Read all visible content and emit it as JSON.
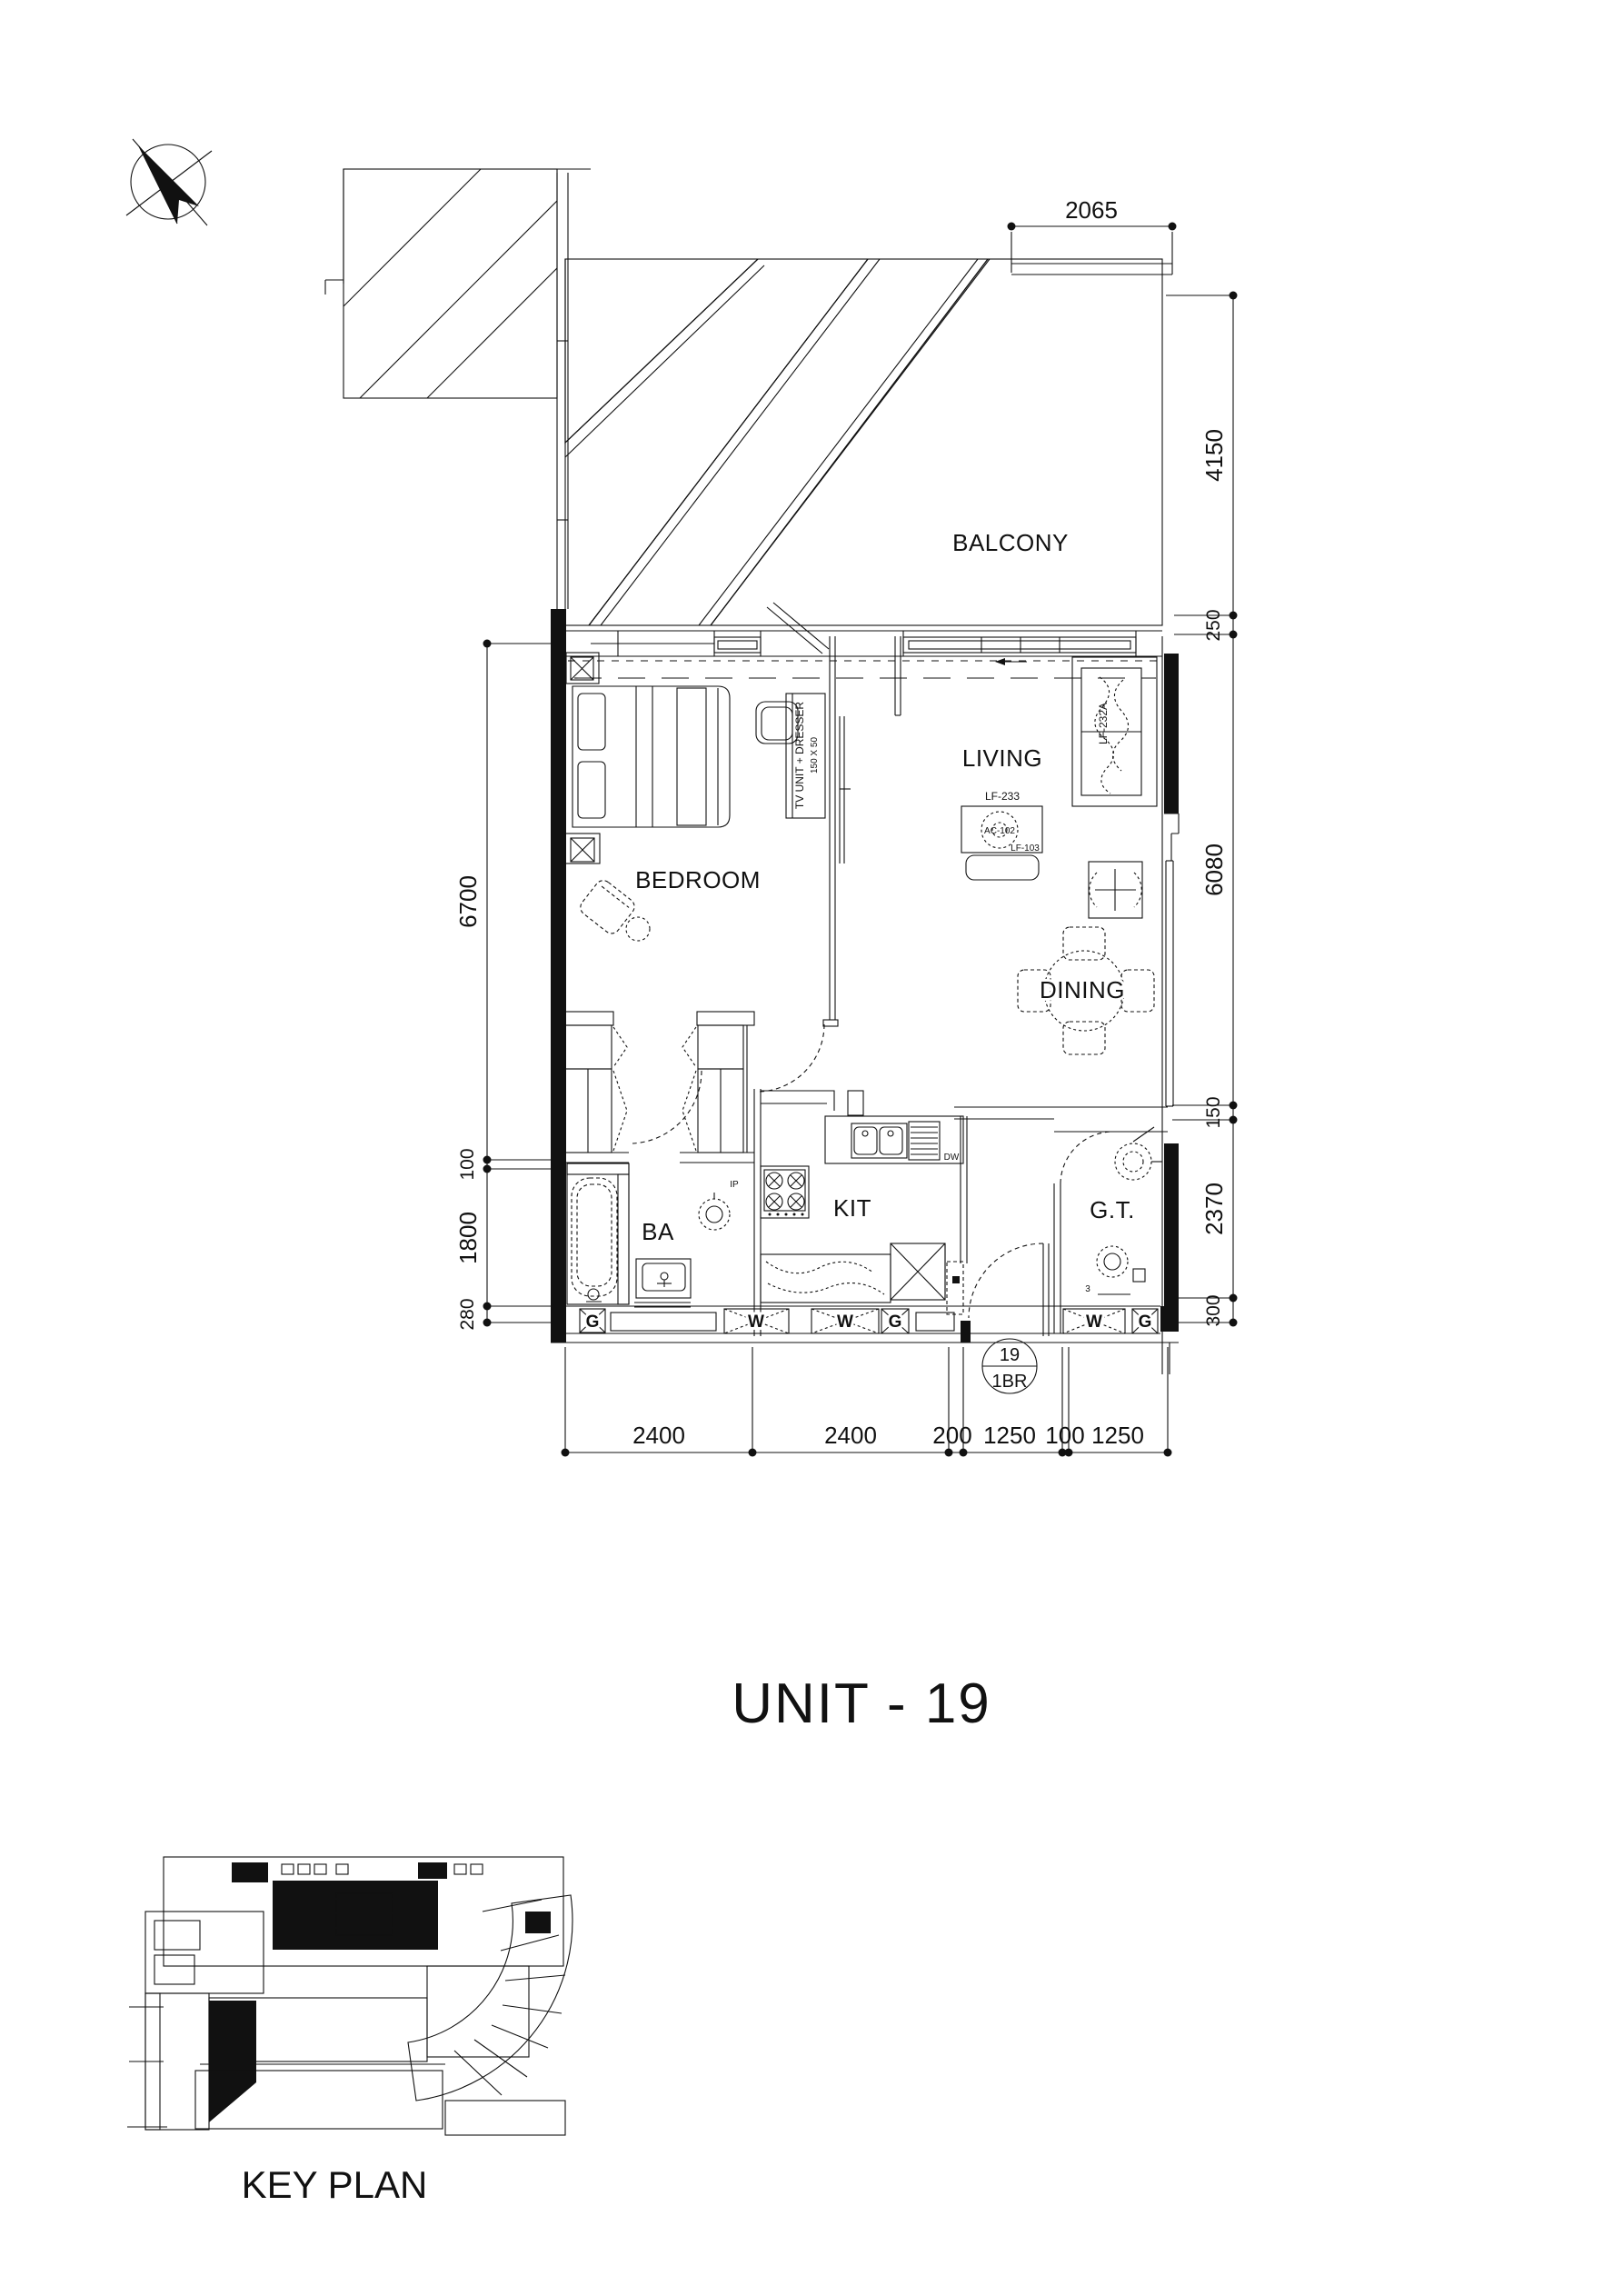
{
  "title": "UNIT - 19",
  "key_plan_label": "KEY PLAN",
  "badge": {
    "number": "19",
    "type": "1BR"
  },
  "rooms": {
    "balcony": "BALCONY",
    "bedroom": "BEDROOM",
    "living": "LIVING",
    "dining": "DINING",
    "bathroom": "BA",
    "kitchen": "KIT",
    "guest_toilet": "G.T."
  },
  "furniture": {
    "tv_unit": "TV UNIT + DRESSER",
    "tv_unit_size": "150 X 50",
    "sofa_tag": "LF-232A",
    "media_tag": "LF-233",
    "ac_tag": "AC-102",
    "table_tag": "LF-103",
    "dishwasher_tag": "DW",
    "bath_tag": "IP",
    "toilet_tag": "3"
  },
  "closets": {
    "w": "W",
    "g": "G"
  },
  "dimensions": {
    "top": [
      "2065"
    ],
    "right": [
      "4150",
      "250",
      "6080",
      "150",
      "2370",
      "300"
    ],
    "left": [
      "6700",
      "100",
      "1800",
      "280"
    ],
    "bottom": [
      "2400",
      "2400",
      "200",
      "1250",
      "100",
      "1250"
    ]
  }
}
